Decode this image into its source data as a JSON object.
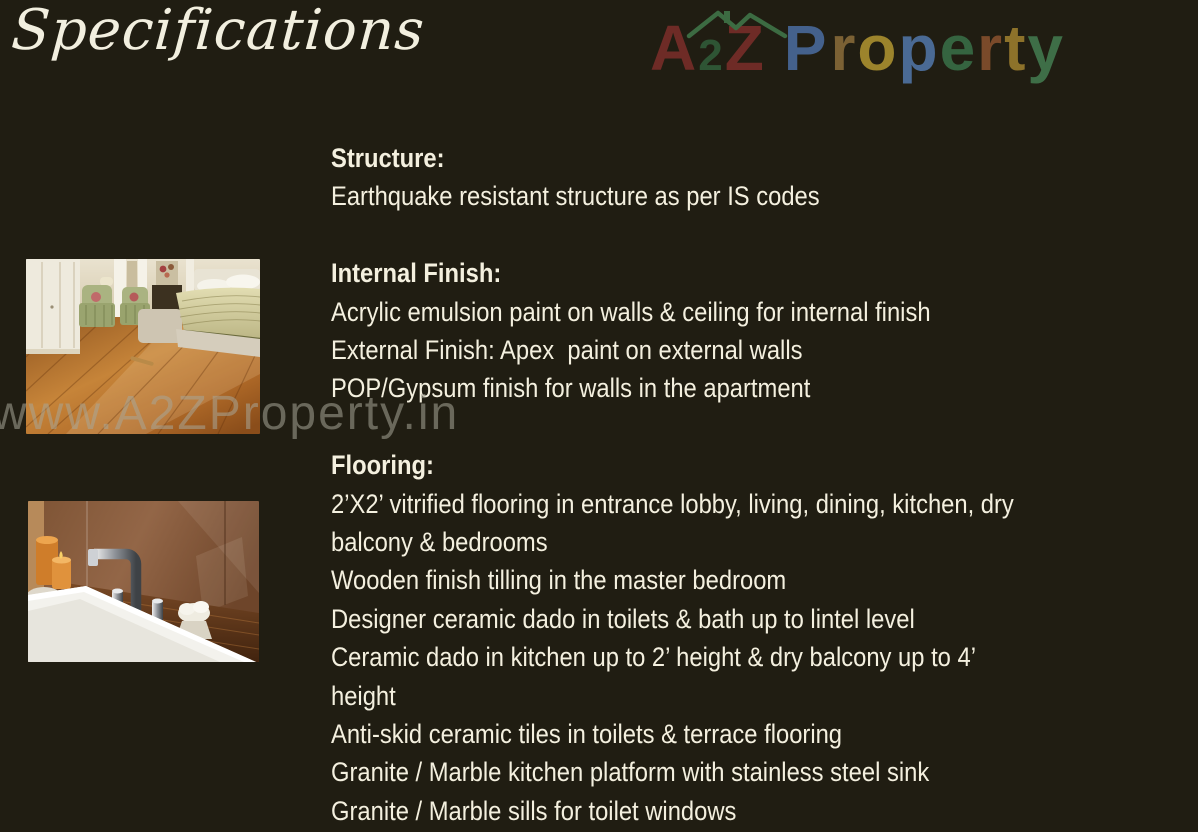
{
  "page": {
    "title": "Specifications",
    "background_color": "#201d12",
    "text_color": "#f4f0df"
  },
  "logo": {
    "name": "A2Z Property",
    "roof_color": "#3c6b42",
    "letters_a2z": [
      {
        "char": "A",
        "color": "#6e2b26"
      },
      {
        "char": "2",
        "color": "#2e5434"
      },
      {
        "char": "Z",
        "color": "#6e2b26"
      }
    ],
    "letters_property": [
      {
        "char": "P",
        "color": "#44618c"
      },
      {
        "char": "r",
        "color": "#7b6134"
      },
      {
        "char": "o",
        "color": "#9c842c"
      },
      {
        "char": "p",
        "color": "#4a6a94"
      },
      {
        "char": "e",
        "color": "#356440"
      },
      {
        "char": "r",
        "color": "#7a4a2a"
      },
      {
        "char": "t",
        "color": "#8d722a"
      },
      {
        "char": "y",
        "color": "#3e6e47"
      }
    ]
  },
  "watermark": {
    "text": "www.A2ZProperty.in",
    "color": "rgba(168,165,152,0.55)"
  },
  "photos": {
    "bedroom": {
      "name": "bedroom-wooden-flooring-photo"
    },
    "bathroom": {
      "name": "bathtub-chrome-faucet-photo"
    }
  },
  "sections": [
    {
      "heading": "Structure:",
      "lines": [
        "Earthquake resistant structure as per IS codes"
      ]
    },
    {
      "heading": "Internal Finish:",
      "lines": [
        "Acrylic emulsion paint on walls & ceiling for internal finish",
        "External Finish: Apex  paint on external walls",
        "POP/Gypsum finish for walls in the apartment"
      ]
    },
    {
      "heading": "Flooring:",
      "lines": [
        "2’X2’ vitrified flooring in entrance lobby, living, dining, kitchen, dry",
        "balcony & bedrooms",
        "Wooden finish tilling in the master bedroom",
        "Designer ceramic dado in toilets & bath up to lintel level",
        "Ceramic dado in kitchen up to 2’ height & dry balcony up to 4’",
        "height",
        "Anti-skid ceramic tiles in toilets & terrace flooring",
        "Granite / Marble kitchen platform with stainless steel sink",
        "Granite / Marble sills for toilet windows"
      ]
    }
  ]
}
